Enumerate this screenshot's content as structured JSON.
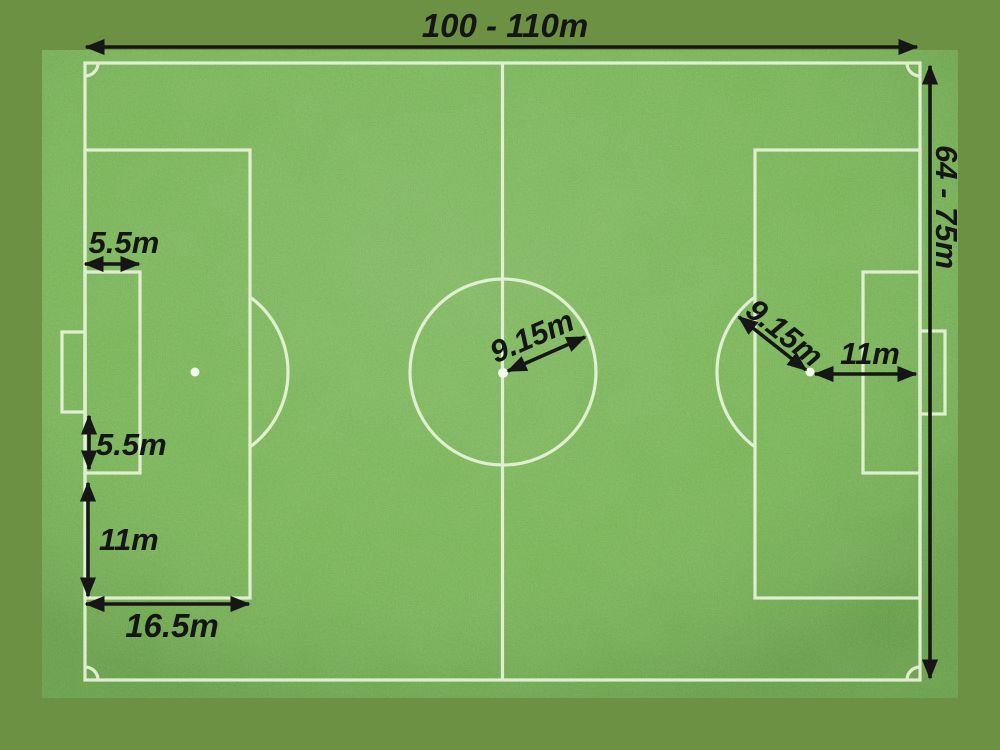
{
  "scene": {
    "description": "Football pitch dimensions diagram on grass photo",
    "background_color": "#6C9143",
    "grass_base_color": "#3E7A1F",
    "field_line_color": "#E8F3DA",
    "annotation_color": "#161616"
  },
  "labels": {
    "pitch_length": "100 - 110m",
    "pitch_width": "64 - 75m",
    "goal_area_depth": "5.5m",
    "goal_to_goal_area": "5.5m",
    "goal_area_to_penalty_edge": "11m",
    "penalty_area_depth": "16.5m",
    "center_circle_radius": "9.15m",
    "penalty_arc_radius": "9.15m",
    "penalty_spot_to_goal_line": "11m"
  }
}
